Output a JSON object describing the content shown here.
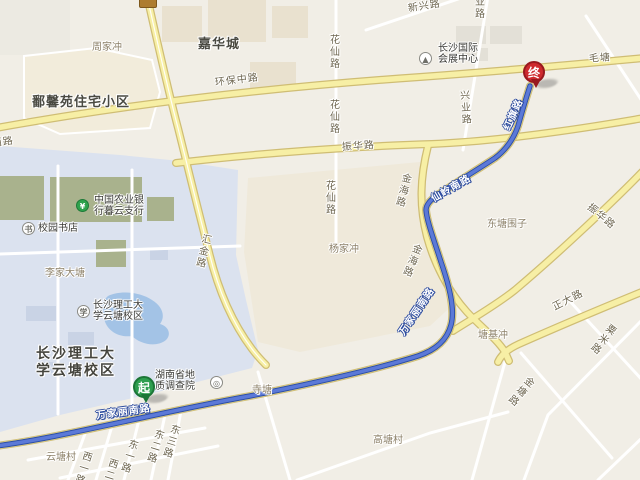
{
  "colors": {
    "background": "#F1EEE6",
    "campus_area": "#DBE2EF",
    "water": "#A3C3E6",
    "green_area": "#A9B28D",
    "road_fill": "#F7EFA5",
    "road_casing": "#CFBD74",
    "route": "#5B79D8",
    "route_casing": "#2E4EA3",
    "start_marker": "#2E9E4F",
    "end_marker": "#CE2A2E"
  },
  "markers": {
    "start": {
      "label": "起"
    },
    "end": {
      "label": "终"
    }
  },
  "icons": {
    "bank": "¥",
    "bookstore": "书",
    "university": "学",
    "geology": "◎",
    "convention": "▲"
  },
  "route_labels": {
    "wanjiali_west": "万家丽南路",
    "wanjiali_bend": "万家丽南路",
    "xianling": "仙岭南路",
    "hongqi": "红旗路"
  },
  "road_labels": {
    "xilu": "西路",
    "huanbao": "环保中路",
    "zhenhua_w": "振华路",
    "zhenhua_e": "振华路",
    "maotang": "毛塘",
    "xinxing": "新兴路",
    "xingye_top": "兴业路",
    "xingye": "兴业路",
    "huaxian_1": "花仙路",
    "huaxian_2": "花仙路",
    "huaxian_3": "花仙路",
    "jinhai_1": "金海路",
    "jinhai_2": "金海路",
    "huijin": "汇金路",
    "zhengda": "正大路",
    "sumi": "粟米路",
    "jintang": "金塘路",
    "dong1": "东一路",
    "dong2": "东二路",
    "dong3": "东三路",
    "xi1": "西一路",
    "xi2": "西二路"
  },
  "area_labels": {
    "zhoujiachong": "周家冲",
    "jiahuacheng": "嘉华城",
    "poxinyuan": "鄱馨苑住宅小区",
    "lijiadatang": "李家大塘",
    "yangjiachong": "杨家冲",
    "dongtangweizi": "东塘围子",
    "tangjichong": "塘基冲",
    "gaotangcun": "高塘村",
    "yuntangcun": "云塘村",
    "sitang": "寺塘",
    "campus_line1": "长沙理工大",
    "campus_line2": "学云塘校区"
  },
  "poi_labels": {
    "bank_line1": "中国农业银",
    "bank_line2": "行暮云支行",
    "bookstore": "校园书店",
    "university_line1": "长沙理工大",
    "university_line2": "学云塘校区",
    "geology_line1": "湖南省地",
    "geology_line2": "质调查院",
    "convention_line1": "长沙国际",
    "convention_line2": "会展中心"
  }
}
